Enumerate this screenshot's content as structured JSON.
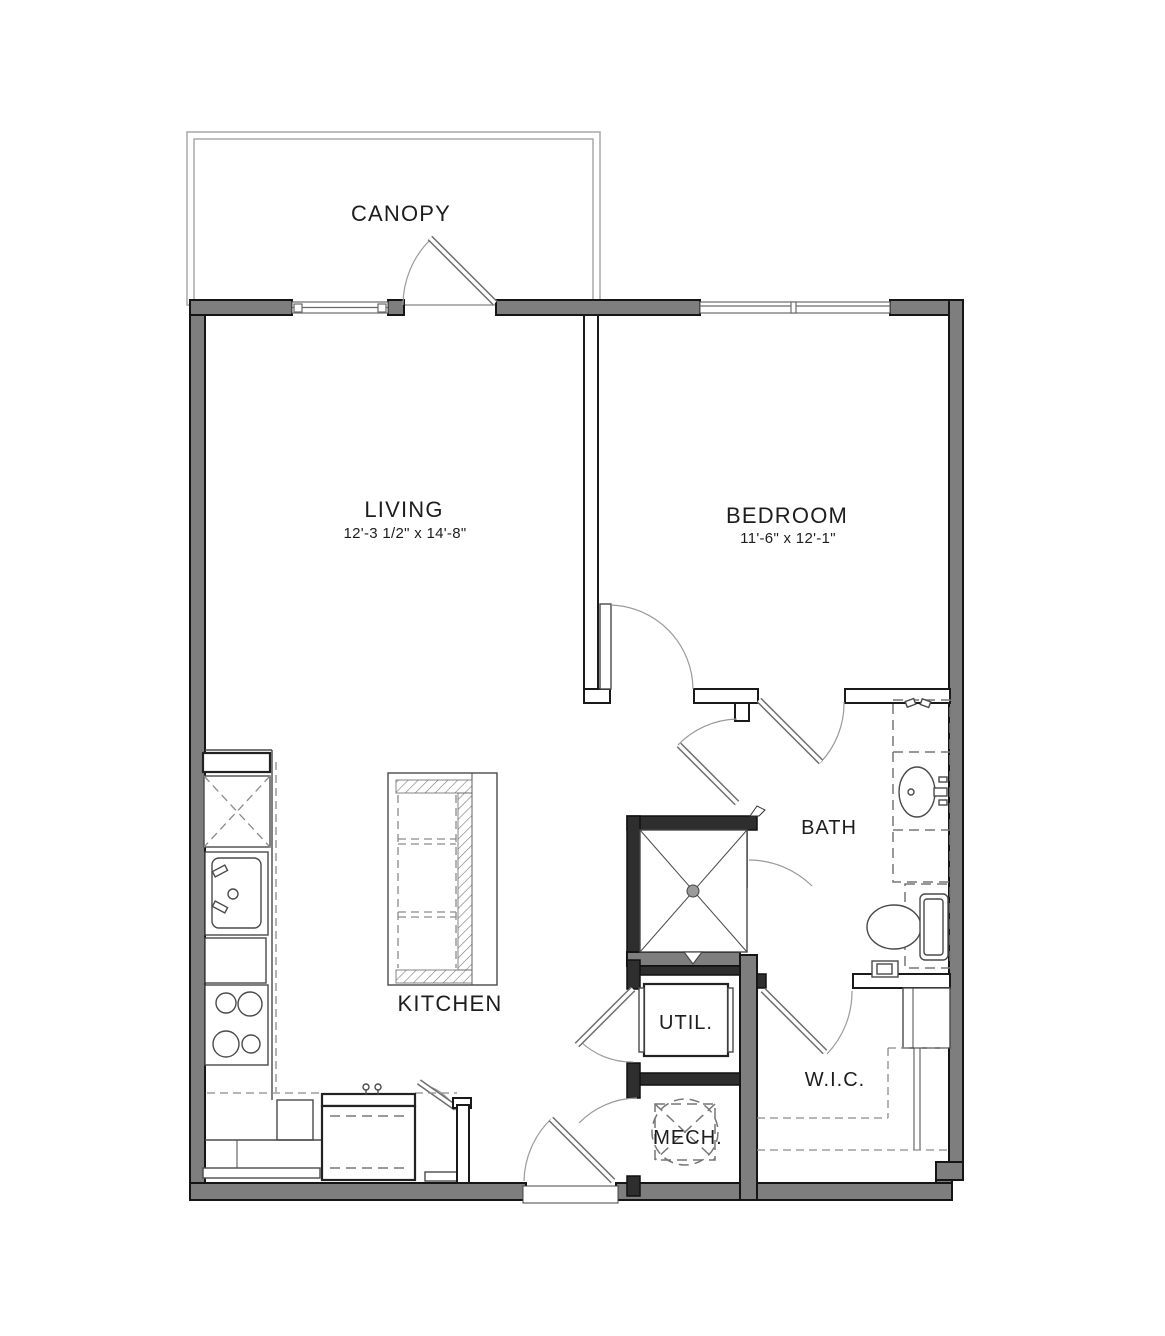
{
  "floor_plan": {
    "canopy": {
      "label": "CANOPY"
    },
    "rooms": {
      "living": {
        "label": "LIVING",
        "dimensions": "12'-3 1/2\" x 14'-8\""
      },
      "bedroom": {
        "label": "BEDROOM",
        "dimensions": "11'-6\" x 12'-1\""
      },
      "kitchen": {
        "label": "KITCHEN"
      },
      "bath": {
        "label": "BATH"
      },
      "utility": {
        "label": "UTIL."
      },
      "mechanical": {
        "label": "MECH."
      },
      "walk_in_closet": {
        "label": "W.I.C."
      }
    },
    "fixtures": [
      "refrigerator",
      "kitchen-sink",
      "dishwasher",
      "range-burners",
      "kitchen-island",
      "shower",
      "washer-dryer",
      "water-heater",
      "vanity-sink",
      "toilet",
      "closet-shelving"
    ],
    "colors": {
      "wall_fill": "#7e7e7e",
      "wall_outline": "#151515",
      "line": "#4a4a4a",
      "background": "#ffffff"
    }
  }
}
